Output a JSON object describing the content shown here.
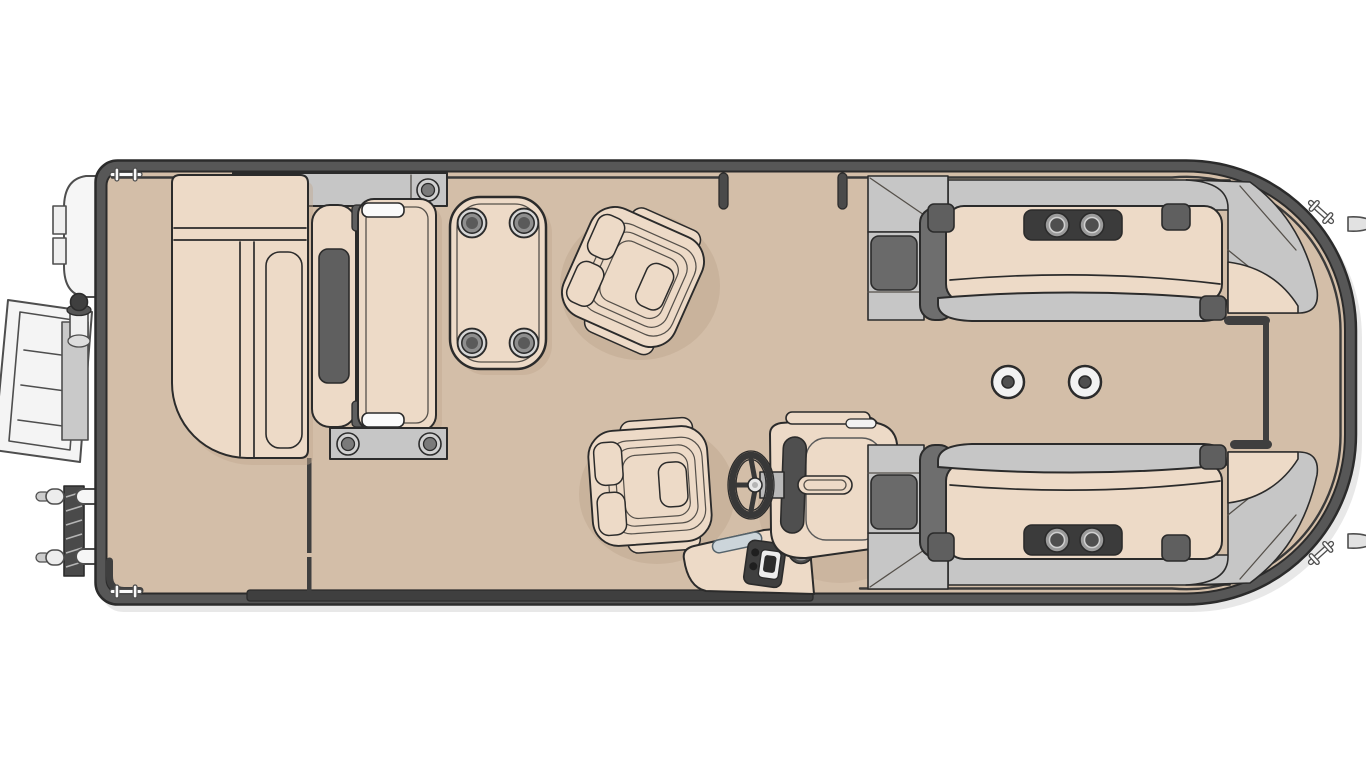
{
  "figure": {
    "title": "Pontoon boat floor plan - overhead deck layout diagram",
    "caption": "Overhead line-art floor plan of a pontoon boat: stern swim platform with outboard pod and boarding ladders, port chaise lounge with cup-holder console, walk-through flip seat, cocktail table with four cup holders, two swivel captain chairs, starboard helm console with steering wheel and throttle, and twin mirrored bow lounges with cup-holder armrests leading to a bow gate."
  },
  "colors": {
    "deck": "#d3bea8",
    "rim": "#575757",
    "outline": "#2b2b2b",
    "cushion": "#eddac7",
    "panel_light": "#c6c6c6",
    "panel_mid": "#a9a9a9",
    "seat_dark": "#6a6a6a",
    "dark": "#4a4a4a",
    "dark2": "#3f3f3f",
    "console_dark": "#3b3b3b",
    "metal": "#f6f6f6",
    "grab": "#ccd5da",
    "shadow": "#c0a890",
    "background": "#ffffff"
  },
  "components": {
    "stern": [
      "outboard-pod",
      "swim-ladder-extended",
      "boarding-ladder-folded",
      "stern-gate-opening"
    ],
    "port_lounge": {
      "type": "chaise-lounge",
      "console_cup_holders": 2,
      "console_fasteners": 1
    },
    "walk_through_seat": {
      "type": "flip-seat",
      "bracket_bolts": 2
    },
    "cocktail_table": {
      "cup_holders": 4
    },
    "swivel_chairs": 2,
    "helm": [
      "steering-wheel",
      "instrument-dash",
      "throttle-control",
      "speaker-gauge",
      "grab-handle"
    ],
    "bow_lounges": {
      "port_cup_holders": 2,
      "starboard_cup_holders": 2
    },
    "deck_table_bases": 2,
    "cleats": 4,
    "bow_eyes": 2,
    "gates": [
      "port-side-gate",
      "stern-corner-gate",
      "bow-gate"
    ]
  }
}
